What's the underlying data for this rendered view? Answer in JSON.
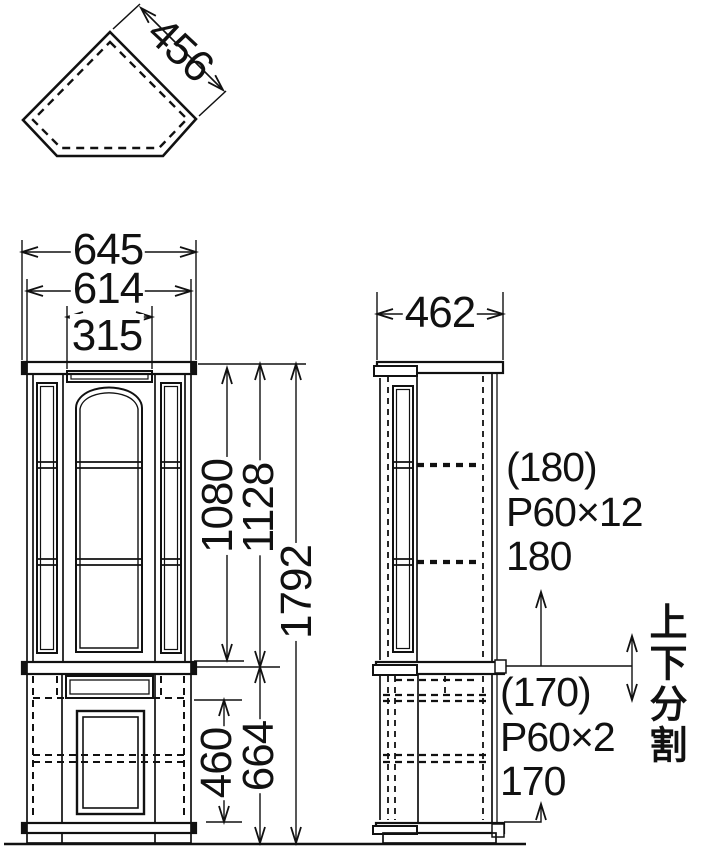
{
  "views": {
    "top_view": {
      "depth": "456"
    },
    "front_view": {
      "outer_width": "645",
      "body_width": "614",
      "center_width": "315",
      "upper_interior_height": "1080",
      "upper_section_height": "1128",
      "total_height": "1792",
      "lower_interior_height": "460",
      "lower_section_height": "664"
    },
    "side_view": {
      "depth": "462"
    },
    "upper_shelf_note": {
      "top_space": "(180)",
      "pitch": "P60×12",
      "bottom_space": "180"
    },
    "lower_shelf_note": {
      "top_space": "(170)",
      "pitch": "P60×2",
      "bottom_space": "170"
    },
    "split_note": {
      "label": "上下分割"
    }
  }
}
